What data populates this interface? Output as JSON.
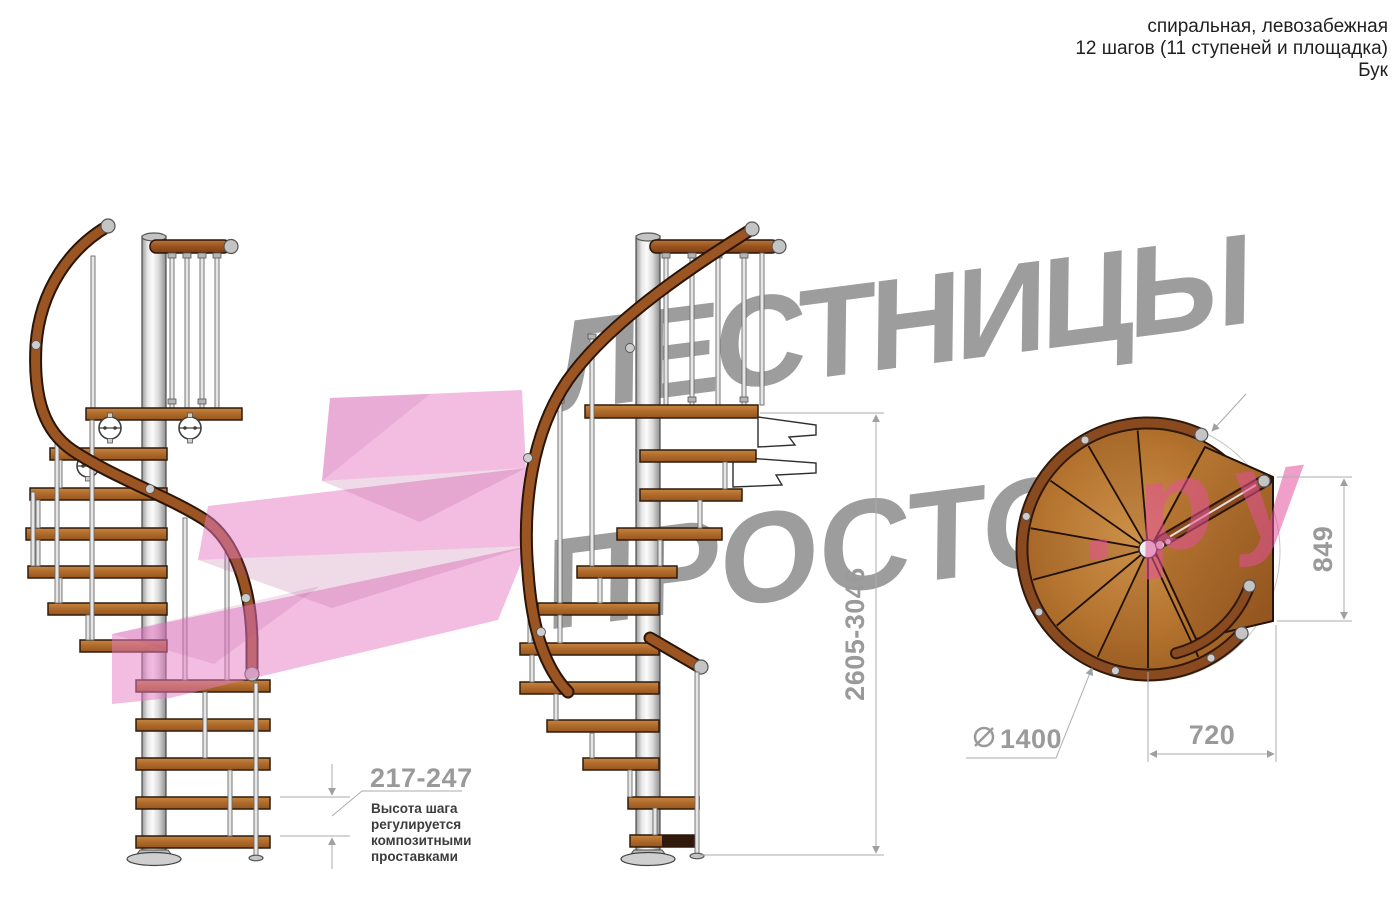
{
  "header": {
    "line1": "спиральная, левозабежная",
    "line2": "12 шагов (11 ступеней и площадка)",
    "line3": "Бук"
  },
  "watermark": {
    "line1": "ЛЕСТНИЦЫ",
    "line2_gray": "ПРОСТО",
    "line2_pink": ".ру"
  },
  "dimensions": {
    "step_height": "217-247",
    "note_lines": [
      "Высота шага",
      "регулируется",
      "композитными",
      "проставками"
    ],
    "total_height": "2605-3046",
    "platform_depth": "849",
    "platform_width": "720",
    "diameter": "1400"
  },
  "colors": {
    "watermark_gray": "#9d9d9d",
    "watermark_pink": "#e4509b",
    "arrow_pink": "#e77cc6",
    "dim_gray": "#9a9a9a",
    "wood_step": "#b06a2c",
    "handrail_wood": "#9a5523",
    "metal_pole": "#d8d8d8"
  }
}
